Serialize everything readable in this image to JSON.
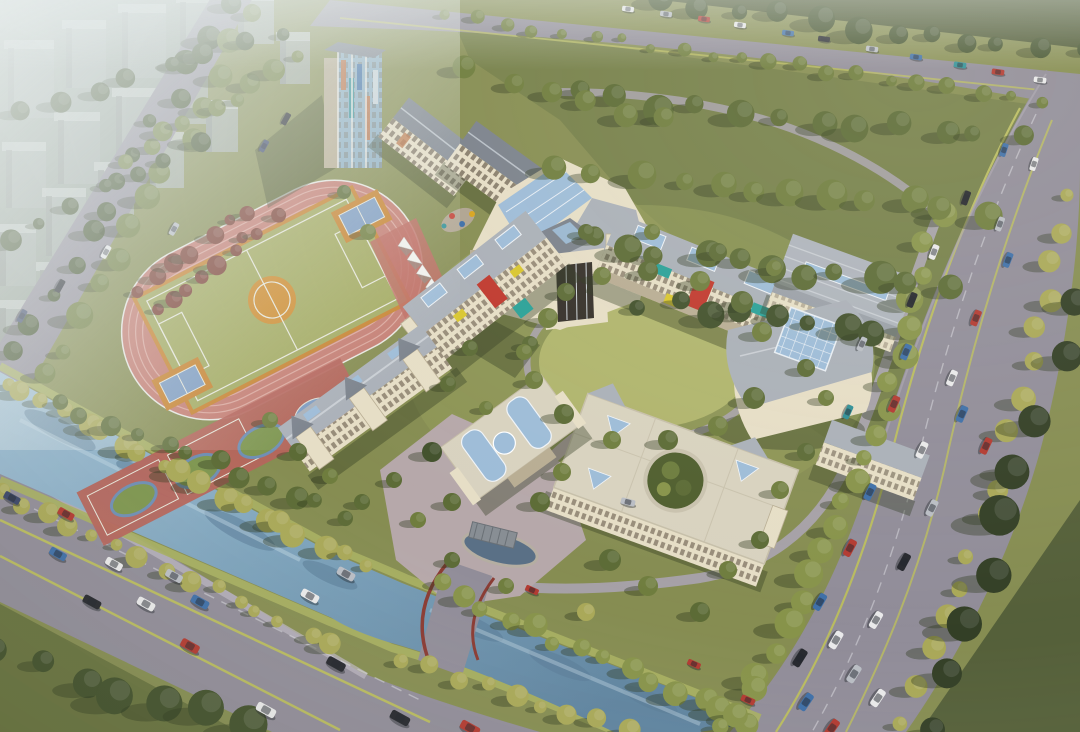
{
  "palette": {
    "ground": "#868d52",
    "woodsGrass": "#76804a",
    "lawnDark": "#68733f",
    "lawnLight": "#b0b56d",
    "plaza": "#b6a8aa",
    "road": "#918d99",
    "roadLight": "#a8a2ac",
    "laneLine": "#b9bb60",
    "bank": "#a8b062",
    "waterLight": "#a4c2d6",
    "waterMid": "#6f95b0",
    "waterDark": "#5a7d98",
    "trackRed": "#c57d72",
    "trackLane": "#dca89e",
    "pitch": "#a3aa60",
    "pitchBorder": "#c8832f",
    "centerOrange": "#cf8c2e",
    "courtBlue": "#7f9dc2",
    "courtRedStrip": "#b5655c",
    "courtGreen": "#7e9650",
    "wallCream": "#e6dec6",
    "wallShade": "#b8ad93",
    "roofGrey": "#aab0b8",
    "roofDark": "#7b828c",
    "roofLight": "#c9ced4",
    "roofCream": "#d8d2bf",
    "glass": "#9dbcd8",
    "accentRed": "#c0392e",
    "accentTeal": "#2aa198",
    "accentYellow": "#d9c62f",
    "bridgeRail": "#8a3b33",
    "cityFront": "#a6aea8",
    "cityTop": "#c6ccc7",
    "citySide": "#8d958f",
    "fog": "#e8eeee",
    "treeColors": {
      "g1": "#5c6b36",
      "g2": "#6f7d3e",
      "g3": "#87934a",
      "y1": "#a9a858",
      "d1": "#42512c",
      "con": "#333f26",
      "red": "#7c4034"
    },
    "carColors": [
      "#e9e9ea",
      "#b9bdc4",
      "#26282e",
      "#b23a31",
      "#3e6fa8",
      "#2f8f96",
      "#3a4668"
    ]
  },
  "scene": {
    "city_blocks": [
      [
        8,
        48,
        46,
        70
      ],
      [
        66,
        28,
        40,
        60
      ],
      [
        122,
        12,
        44,
        66
      ],
      [
        180,
        2,
        40,
        54
      ],
      [
        238,
        0,
        36,
        44
      ],
      [
        280,
        40,
        30,
        44
      ],
      [
        6,
        150,
        40,
        58
      ],
      [
        58,
        120,
        42,
        64
      ],
      [
        116,
        96,
        40,
        58
      ],
      [
        170,
        72,
        38,
        52
      ],
      [
        0,
        232,
        36,
        54
      ],
      [
        46,
        196,
        40,
        60
      ],
      [
        98,
        170,
        36,
        52
      ],
      [
        150,
        140,
        34,
        48
      ],
      [
        206,
        108,
        32,
        44
      ],
      [
        0,
        308,
        30,
        48
      ],
      [
        40,
        270,
        34,
        50
      ]
    ],
    "tree_belts": [
      [
        226,
        8,
        18,
        350,
        13,
        9,
        "d1"
      ],
      [
        255,
        16,
        44,
        378,
        13,
        10,
        "g2"
      ],
      [
        124,
        158,
        298,
        58,
        9,
        8,
        "g2"
      ],
      [
        8,
        384,
        358,
        566,
        19,
        9,
        "y1"
      ],
      [
        4,
        494,
        330,
        642,
        15,
        8,
        "y1"
      ],
      [
        438,
        586,
        748,
        724,
        14,
        9,
        "g3"
      ],
      [
        398,
        658,
        628,
        732,
        9,
        8,
        "y1"
      ],
      [
        6,
        650,
        240,
        730,
        7,
        15,
        "d1"
      ],
      [
        60,
        402,
        348,
        514,
        12,
        9,
        "g1"
      ],
      [
        160,
        310,
        278,
        218,
        9,
        8,
        "red"
      ],
      [
        140,
        292,
        250,
        210,
        7,
        7,
        "red"
      ],
      [
        936,
        220,
        868,
        462,
        10,
        10,
        "g3"
      ],
      [
        860,
        480,
        762,
        678,
        9,
        11,
        "g3"
      ],
      [
        748,
        692,
        720,
        730,
        3,
        10,
        "g3"
      ],
      [
        1070,
        196,
        1006,
        468,
        9,
        9,
        "y1"
      ],
      [
        998,
        486,
        900,
        718,
        8,
        10,
        "y1"
      ],
      [
        1080,
        310,
        934,
        730,
        9,
        15,
        "con"
      ],
      [
        446,
        16,
        1038,
        100,
        21,
        6,
        "g2"
      ],
      [
        664,
        2,
        1078,
        54,
        12,
        10,
        "d1"
      ],
      [
        582,
        96,
        1018,
        140,
        12,
        11,
        "g1"
      ],
      [
        562,
        162,
        988,
        216,
        12,
        12,
        "g2"
      ],
      [
        592,
        238,
        948,
        292,
        11,
        12,
        "g1"
      ],
      [
        640,
        302,
        878,
        332,
        8,
        10,
        "d1"
      ],
      [
        20,
        110,
        280,
        30,
        8,
        8,
        "d1"
      ],
      [
        10,
        240,
        200,
        140,
        7,
        8,
        "d1"
      ],
      [
        470,
        70,
        660,
        120,
        6,
        9,
        "g2"
      ]
    ],
    "trees": [
      [
        548,
        318,
        10,
        "g2"
      ],
      [
        566,
        292,
        9,
        "g1"
      ],
      [
        602,
        276,
        9,
        "g2"
      ],
      [
        648,
        271,
        10,
        "g1"
      ],
      [
        700,
        281,
        10,
        "g2"
      ],
      [
        742,
        302,
        11,
        "g1"
      ],
      [
        762,
        332,
        10,
        "g2"
      ],
      [
        754,
        398,
        11,
        "g1"
      ],
      [
        718,
        426,
        10,
        "g2"
      ],
      [
        668,
        440,
        10,
        "g1"
      ],
      [
        612,
        440,
        9,
        "g2"
      ],
      [
        564,
        414,
        10,
        "g1"
      ],
      [
        534,
        380,
        9,
        "g2"
      ],
      [
        530,
        344,
        8,
        "g1"
      ],
      [
        432,
        452,
        10,
        "d1"
      ],
      [
        452,
        502,
        9,
        "g1"
      ],
      [
        540,
        502,
        10,
        "g1"
      ],
      [
        562,
        472,
        9,
        "g2"
      ],
      [
        610,
        560,
        11,
        "g1"
      ],
      [
        648,
        586,
        10,
        "g2"
      ],
      [
        700,
        612,
        10,
        "g1"
      ],
      [
        586,
        612,
        9,
        "y1"
      ],
      [
        506,
        586,
        8,
        "g2"
      ],
      [
        452,
        560,
        8,
        "g1"
      ],
      [
        418,
        520,
        8,
        "g2"
      ],
      [
        394,
        480,
        8,
        "g1"
      ],
      [
        470,
        348,
        8,
        "g1"
      ],
      [
        524,
        352,
        8,
        "g2"
      ],
      [
        586,
        232,
        8,
        "g1"
      ],
      [
        652,
        232,
        8,
        "g2"
      ],
      [
        718,
        252,
        9,
        "g1"
      ],
      [
        774,
        268,
        8,
        "g2"
      ],
      [
        806,
        368,
        9,
        "g1"
      ],
      [
        826,
        398,
        8,
        "g2"
      ],
      [
        806,
        452,
        9,
        "g1"
      ],
      [
        780,
        490,
        9,
        "g2"
      ],
      [
        760,
        540,
        9,
        "g1"
      ],
      [
        728,
        570,
        9,
        "g2"
      ],
      [
        368,
        232,
        8,
        "g2"
      ],
      [
        344,
        192,
        7,
        "g1"
      ],
      [
        448,
        384,
        8,
        "g1"
      ],
      [
        486,
        408,
        7,
        "g2"
      ],
      [
        298,
        452,
        9,
        "g1"
      ],
      [
        330,
        476,
        8,
        "g2"
      ],
      [
        362,
        502,
        8,
        "g1"
      ],
      [
        270,
        420,
        8,
        "g2"
      ]
    ],
    "cars": [
      [
        628,
        9,
        8,
        0,
        0.7
      ],
      [
        666,
        14,
        8,
        1,
        0.7
      ],
      [
        704,
        19,
        8,
        3,
        0.7
      ],
      [
        740,
        25,
        8,
        0,
        0.7
      ],
      [
        788,
        33,
        8,
        4,
        0.7
      ],
      [
        824,
        39,
        8,
        2,
        0.7
      ],
      [
        872,
        49,
        8,
        1,
        0.72
      ],
      [
        916,
        57,
        8,
        4,
        0.72
      ],
      [
        960,
        65,
        8,
        5,
        0.74
      ],
      [
        998,
        72,
        8,
        3,
        0.74
      ],
      [
        1040,
        80,
        8,
        0,
        0.74
      ],
      [
        286,
        119,
        119,
        2,
        0.75
      ],
      [
        264,
        146,
        119,
        6,
        0.75
      ],
      [
        174,
        229,
        119,
        1,
        0.78
      ],
      [
        106,
        252,
        119,
        0,
        0.8
      ],
      [
        60,
        286,
        119,
        2,
        0.8
      ],
      [
        22,
        316,
        119,
        6,
        0.8
      ],
      [
        1004,
        150,
        108,
        4,
        0.8
      ],
      [
        1034,
        164,
        108,
        0,
        0.8
      ],
      [
        966,
        198,
        110,
        2,
        0.85
      ],
      [
        1000,
        224,
        110,
        1,
        0.85
      ],
      [
        934,
        252,
        111,
        0,
        0.9
      ],
      [
        1008,
        260,
        111,
        4,
        0.9
      ],
      [
        912,
        300,
        112,
        2,
        0.9
      ],
      [
        976,
        318,
        112,
        3,
        0.95
      ],
      [
        906,
        352,
        113,
        4,
        0.95
      ],
      [
        952,
        378,
        113,
        0,
        0.95
      ],
      [
        894,
        404,
        114,
        3,
        1
      ],
      [
        962,
        414,
        114,
        4,
        1
      ],
      [
        922,
        450,
        115,
        0,
        1
      ],
      [
        986,
        446,
        115,
        3,
        1
      ],
      [
        870,
        492,
        116,
        4,
        1
      ],
      [
        932,
        508,
        116,
        1,
        1
      ],
      [
        850,
        548,
        118,
        3,
        1.05
      ],
      [
        904,
        562,
        118,
        2,
        1.05
      ],
      [
        820,
        602,
        120,
        4,
        1.05
      ],
      [
        876,
        620,
        120,
        0,
        1.05
      ],
      [
        836,
        640,
        120,
        0,
        1.1
      ],
      [
        800,
        658,
        122,
        2,
        1.1
      ],
      [
        854,
        674,
        122,
        1,
        1.1
      ],
      [
        806,
        702,
        124,
        4,
        1.1
      ],
      [
        878,
        698,
        124,
        0,
        1.1
      ],
      [
        832,
        728,
        125,
        3,
        1.1
      ],
      [
        12,
        498,
        29,
        6,
        1
      ],
      [
        66,
        514,
        29,
        3,
        1
      ],
      [
        58,
        554,
        29,
        4,
        1.05
      ],
      [
        114,
        564,
        29,
        0,
        1.05
      ],
      [
        174,
        576,
        29,
        1,
        1.05
      ],
      [
        92,
        602,
        29,
        2,
        1.1
      ],
      [
        146,
        604,
        29,
        0,
        1.1
      ],
      [
        200,
        602,
        29,
        4,
        1.1
      ],
      [
        190,
        646,
        29,
        3,
        1.15
      ],
      [
        266,
        710,
        29,
        0,
        1.2
      ],
      [
        336,
        664,
        29,
        2,
        1.15
      ],
      [
        400,
        718,
        29,
        2,
        1.2
      ],
      [
        470,
        728,
        29,
        3,
        1.2
      ],
      [
        310,
        596,
        29,
        0,
        1.1
      ],
      [
        346,
        574,
        29,
        1,
        1.1
      ],
      [
        532,
        590,
        24,
        3,
        0.8
      ],
      [
        694,
        664,
        24,
        3,
        0.8
      ],
      [
        748,
        700,
        24,
        3,
        0.85
      ],
      [
        848,
        412,
        114,
        5,
        0.85
      ],
      [
        862,
        344,
        114,
        1,
        0.85
      ],
      [
        628,
        502,
        14,
        1,
        0.85
      ]
    ],
    "canopies": {
      "x": 398,
      "y": 246,
      "dx": 9.2,
      "dy": 13.8,
      "n": 7
    },
    "playground": [
      [
        452,
        216,
        3,
        "#c23b30"
      ],
      [
        462,
        224,
        3,
        "#3c6ea8"
      ],
      [
        472,
        214,
        3,
        "#d8a41c"
      ],
      [
        444,
        226,
        2.5,
        "#2f8f96"
      ]
    ]
  }
}
